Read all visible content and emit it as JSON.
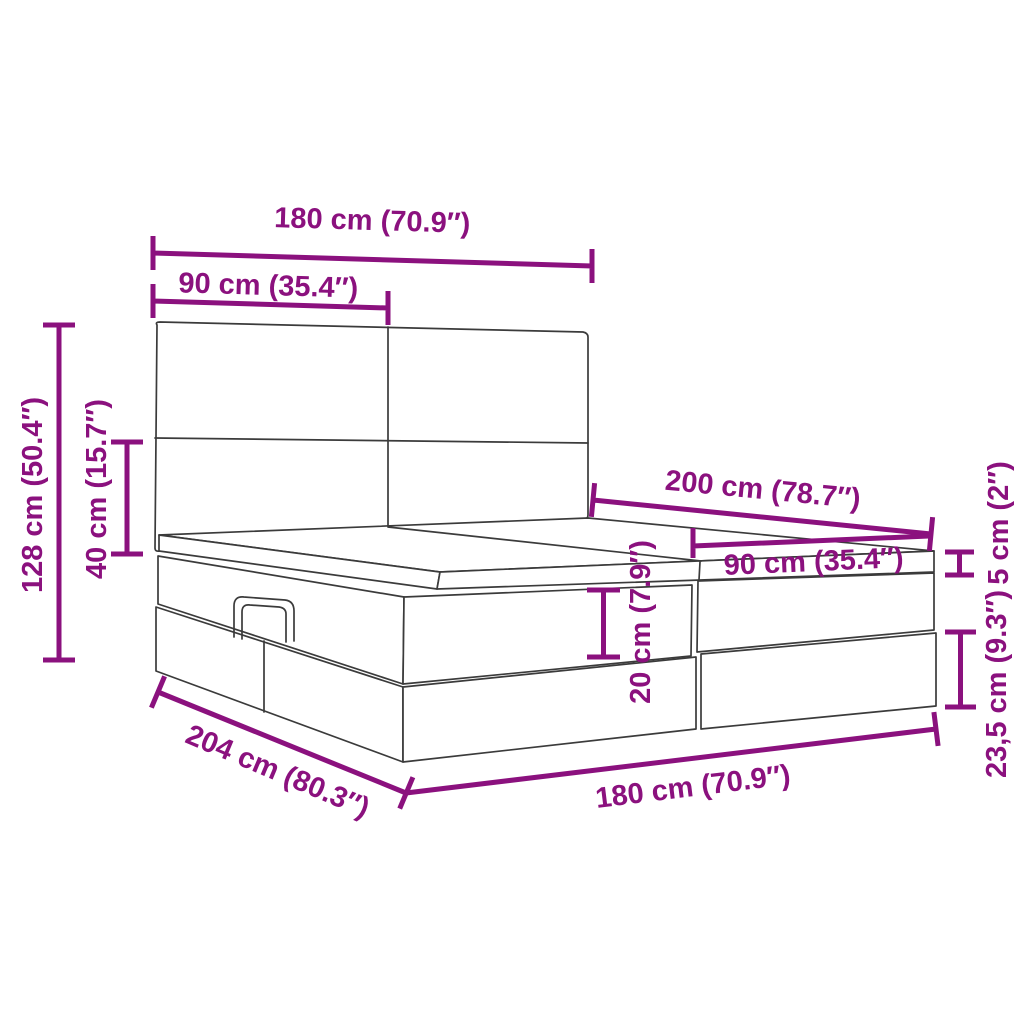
{
  "diagram": {
    "type": "product-dimension-diagram",
    "subject": "ottoman-storage-bed-with-headboard",
    "background_color": "#ffffff",
    "accent_color": "#8B117E",
    "line_color": "#3b3b3b",
    "dimensions": {
      "headboard_width": "180 cm (70.9″)",
      "headboard_panel_width": "90 cm (35.4″)",
      "total_height": "128 cm (50.4″)",
      "headboard_above_base_height": "40 cm (15.7″)",
      "bed_length": "200 cm (78.7″)",
      "half_width_at_foot": "90 cm (35.4″)",
      "topper_thickness": "5 cm (2″)",
      "upper_box_height": "20 cm (7.9″)",
      "lower_box_height": "23,5 cm (9.3″)",
      "outer_length": "204 cm (80.3″)",
      "outer_width": "180 cm (70.9″)"
    }
  }
}
